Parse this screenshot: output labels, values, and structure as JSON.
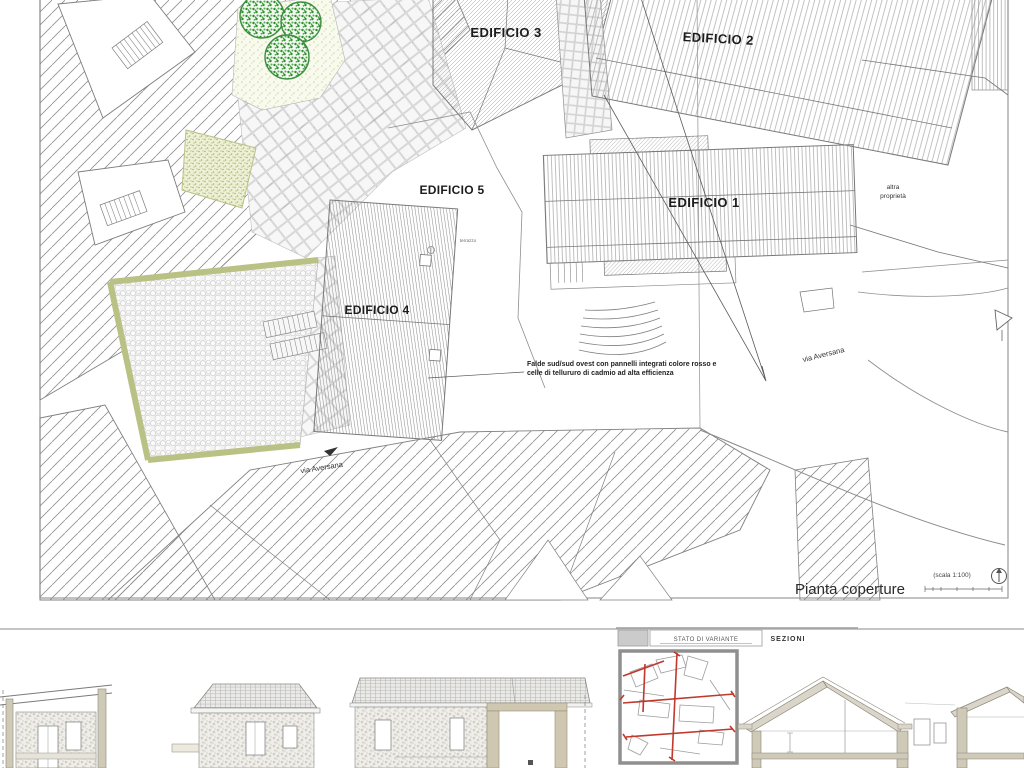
{
  "plan": {
    "buildings": {
      "e1": "EDIFICIO 1",
      "e2": "EDIFICIO 2",
      "e3": "EDIFICIO 3",
      "e4": "EDIFICIO 4",
      "e5": "EDIFICIO 5"
    },
    "labels": {
      "terrazzo": "terrazzo",
      "altra_line1": "altra",
      "altra_line2": "proprietà",
      "via_aversana": "via Aversana",
      "annotation_line1": "Falde sud/sud ovest con pannelli integrati colore rosso e",
      "annotation_line2": "celle di tellururo di cadmio  ad alta efficienza",
      "title": "Pianta coperture",
      "scale": "(scala 1:100)"
    }
  },
  "titleblock": {
    "variant_label": "STATO DI VARIANTE",
    "sections_label": "SEZIONI"
  },
  "colors": {
    "section_line_red": "#c0392b",
    "tree_green": "#3e8e41",
    "hedge_olive": "#b9c184",
    "wall_tan": "#cfc9b8",
    "roof_tan": "#d9d5c9"
  }
}
